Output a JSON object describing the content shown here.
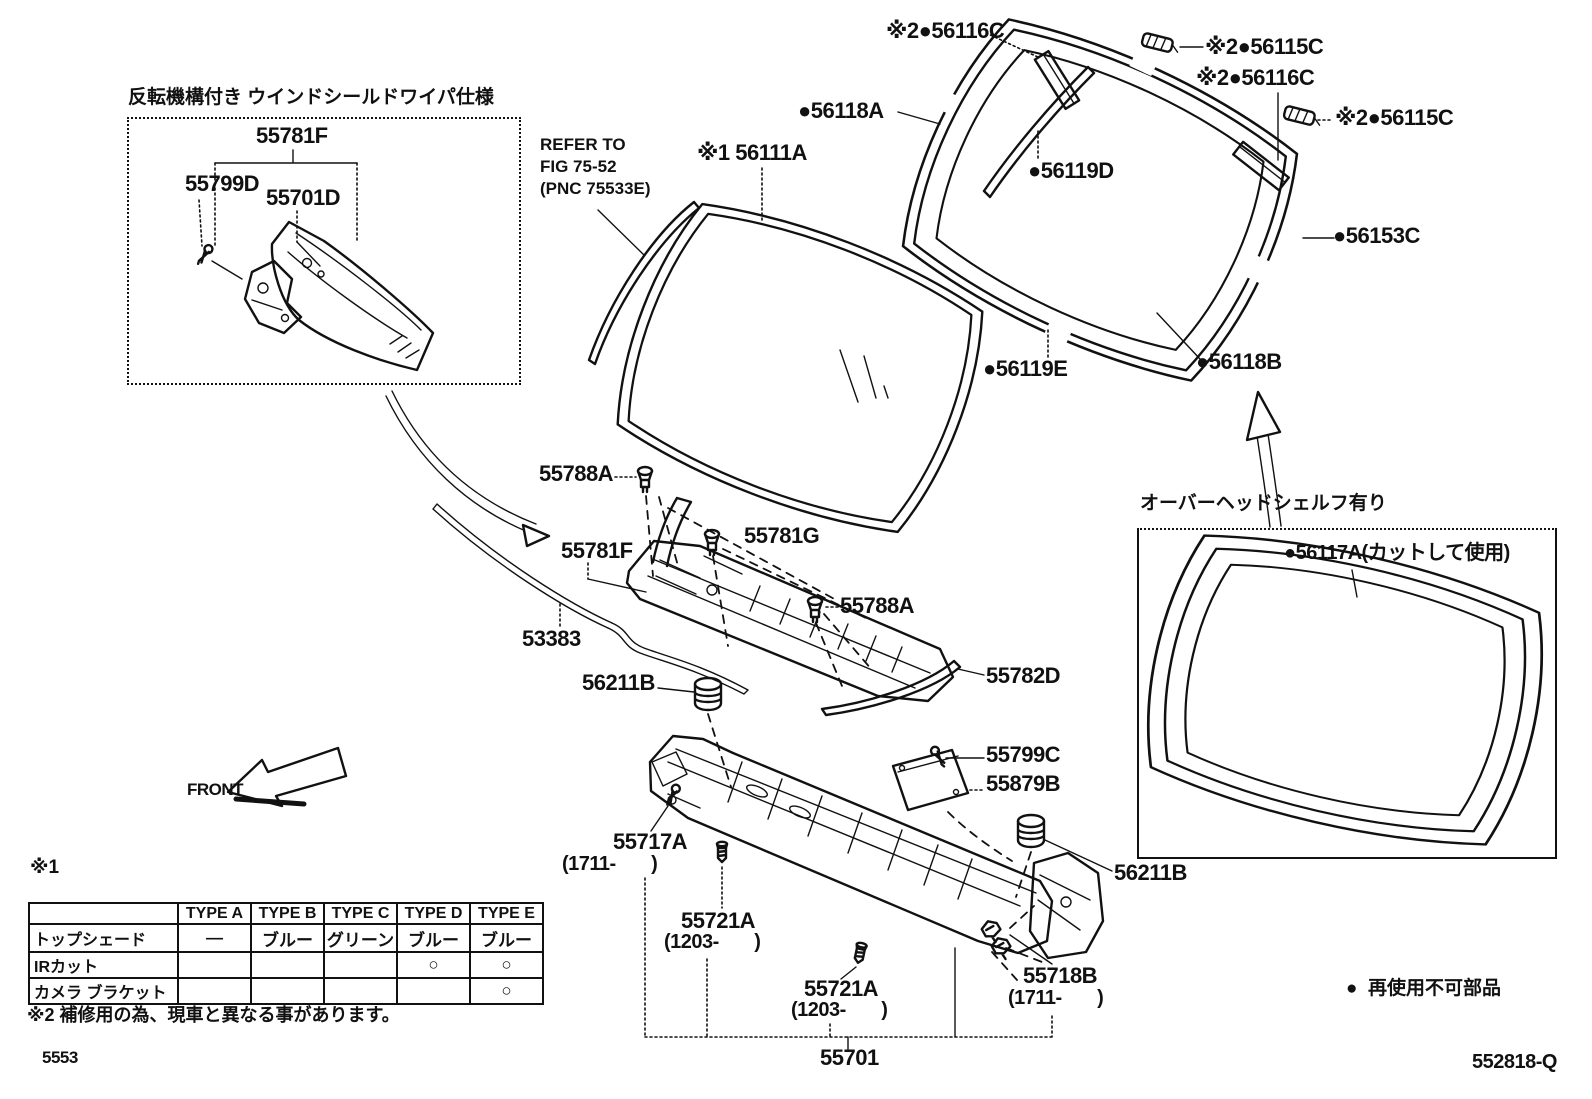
{
  "colors": {
    "ink": "#111111",
    "paper": "#ffffff"
  },
  "boxes": {
    "wiper_title": "反転機構付き ウインドシールドワイパ仕様",
    "shelf_title": "オーバーヘッドシェルフ有り"
  },
  "parts": {
    "box_55781f": "55781F",
    "box_55799d": "55799D",
    "box_55701d": "55701D",
    "refer_line1": "REFER TO",
    "refer_line2": "FIG 75-52",
    "refer_line3": "(PNC 75533E)",
    "w56111a": "※1 56111A",
    "w56116c_a": "※2●56116C",
    "w56115c_a": "※2●56115C",
    "w56116c_b": "※2●56116C",
    "w56115c_b": "※2●56115C",
    "w56118a": "●56118A",
    "w56119d": "●56119D",
    "w56153c": "●56153C",
    "w56119e": "●56119E",
    "w56118b": "●56118B",
    "shelf_56117a": "●56117A(カットして使用)",
    "mid_55788a_1": "55788A",
    "mid_55781g": "55781G",
    "mid_55781f": "55781F",
    "mid_53383": "53383",
    "mid_55788a_2": "55788A",
    "mid_55782d": "55782D",
    "mid_56211b_l": "56211B",
    "mid_55799c": "55799C",
    "mid_55879b": "55879B",
    "mid_56211b_r": "56211B",
    "c55717a": "55717A",
    "c55717a_sub": "(1711-       )",
    "c55721a_1": "55721A",
    "c55721a_1_sub": "(1203-       )",
    "c55721a_2": "55721A",
    "c55721a_2_sub": "(1203-       )",
    "c55718b": "55718B",
    "c55718b_sub": "(1711-       )",
    "c55701": "55701"
  },
  "notes": {
    "n1": "※1",
    "n2": "※2 補修用の為、現車と異なる事があります。",
    "reuse": "●  再使用不可部品",
    "front": "FRONT",
    "page_code": "5553",
    "doc_code": "552818-Q"
  },
  "table": {
    "headers": [
      "",
      "TYPE A",
      "TYPE B",
      "TYPE C",
      "TYPE D",
      "TYPE E"
    ],
    "rows": [
      {
        "label": "トップシェード",
        "cells": [
          "―",
          "ブルー",
          "グリーン",
          "ブルー",
          "ブルー"
        ]
      },
      {
        "label": "IRカット",
        "cells": [
          "",
          "",
          "",
          "○",
          "○"
        ]
      },
      {
        "label": "カメラ ブラケット",
        "cells": [
          "",
          "",
          "",
          "",
          "○"
        ]
      }
    ]
  }
}
